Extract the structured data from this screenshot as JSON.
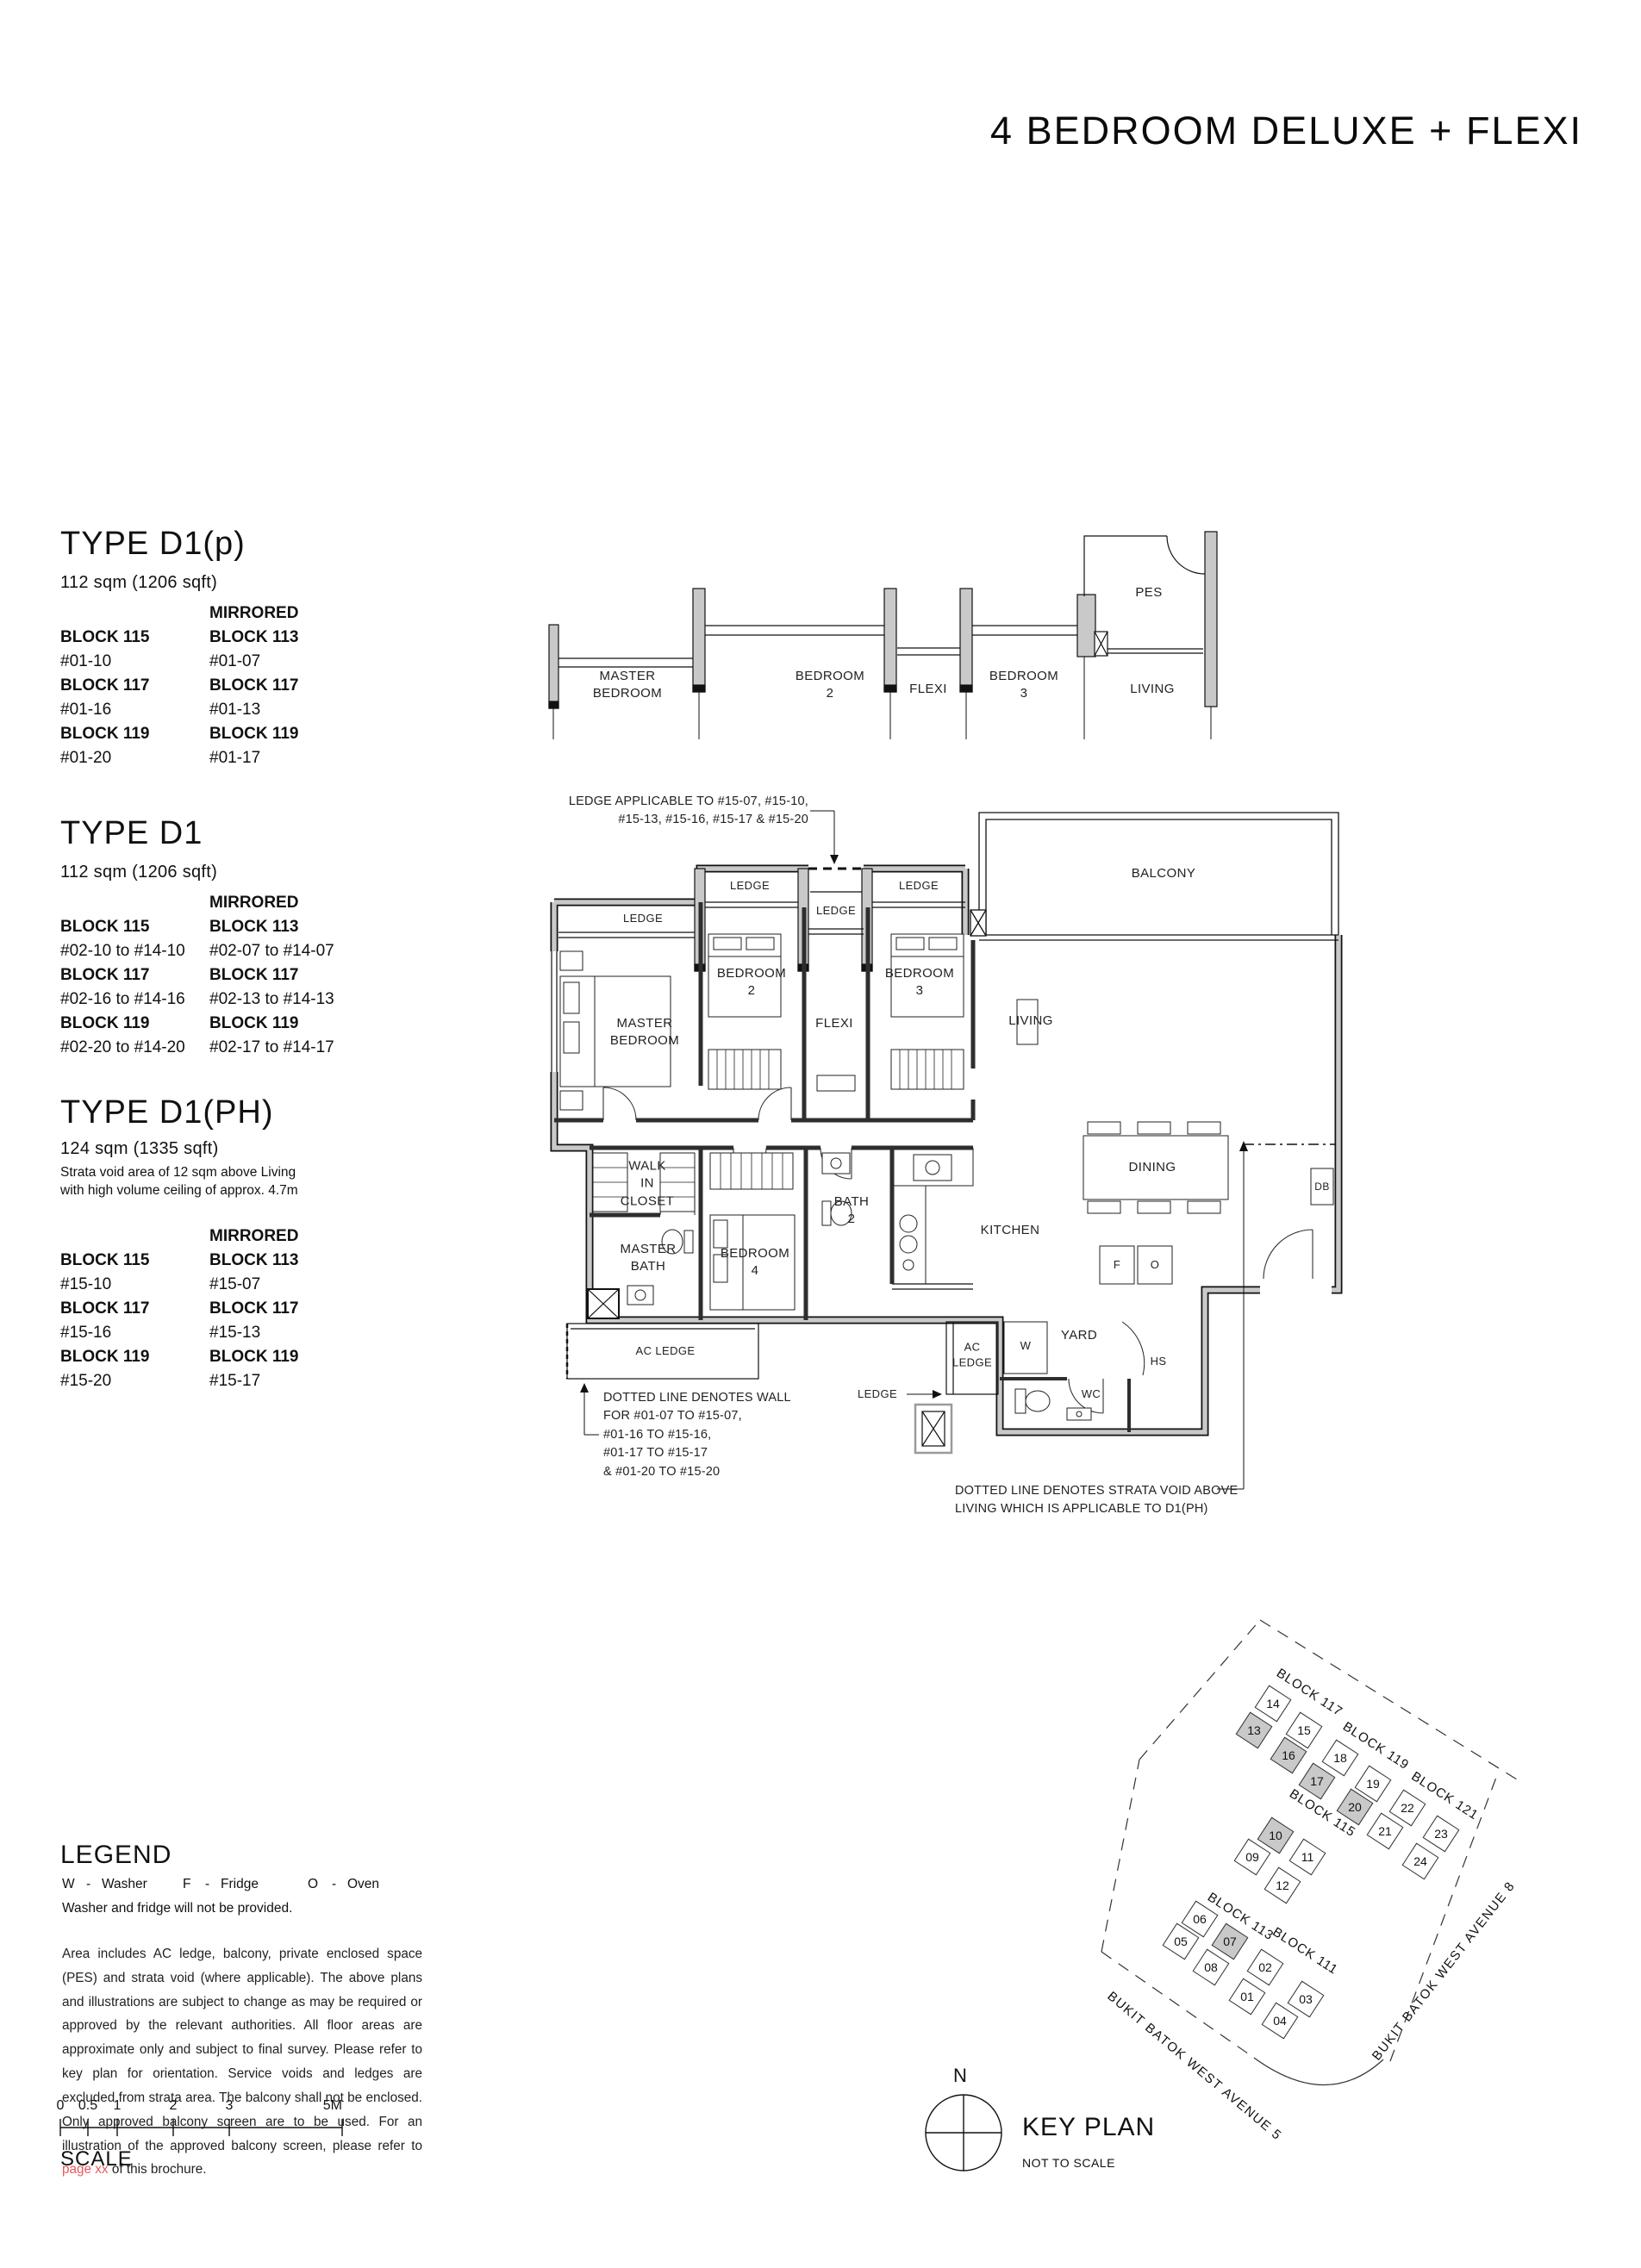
{
  "title": "4 BEDROOM DELUXE + FLEXI",
  "types": [
    {
      "name": "TYPE D1(p)",
      "area": "112 sqm (1206 sqft)",
      "note": "",
      "mirrored": "MIRRORED",
      "left": [
        [
          "BLOCK 115",
          "#01-10"
        ],
        [
          "BLOCK 117",
          "#01-16"
        ],
        [
          "BLOCK 119",
          "#01-20"
        ]
      ],
      "right": [
        [
          "BLOCK 113",
          "#01-07"
        ],
        [
          "BLOCK 117",
          "#01-13"
        ],
        [
          "BLOCK 119",
          "#01-17"
        ]
      ]
    },
    {
      "name": "TYPE D1",
      "area": "112 sqm (1206 sqft)",
      "note": "",
      "mirrored": "MIRRORED",
      "left": [
        [
          "BLOCK 115",
          "#02-10 to #14-10"
        ],
        [
          "BLOCK 117",
          "#02-16 to #14-16"
        ],
        [
          "BLOCK 119",
          "#02-20 to #14-20"
        ]
      ],
      "right": [
        [
          "BLOCK 113",
          "#02-07 to #14-07"
        ],
        [
          "BLOCK 117",
          "#02-13 to #14-13"
        ],
        [
          "BLOCK 119",
          "#02-17 to #14-17"
        ]
      ]
    },
    {
      "name": "TYPE D1(PH)",
      "area": "124 sqm (1335 sqft)",
      "note": "Strata void area of 12 sqm above Living\nwith high volume ceiling of approx. 4.7m",
      "mirrored": "MIRRORED",
      "left": [
        [
          "BLOCK 115",
          "#15-10"
        ],
        [
          "BLOCK 117",
          "#15-16"
        ],
        [
          "BLOCK 119",
          "#15-20"
        ]
      ],
      "right": [
        [
          "BLOCK 113",
          "#15-07"
        ],
        [
          "BLOCK 117",
          "#15-13"
        ],
        [
          "BLOCK 119",
          "#15-17"
        ]
      ]
    }
  ],
  "plan": {
    "upper": {
      "master": "MASTER\nBEDROOM",
      "bed2": "BEDROOM\n2",
      "flexi": "FLEXI",
      "bed3": "BEDROOM\n3",
      "living": "LIVING",
      "pes": "PES"
    },
    "main": {
      "ledge_left": "LEDGE",
      "ledge_b2": "LEDGE",
      "ledge_mid": "LEDGE",
      "ledge_b3": "LEDGE",
      "balcony": "BALCONY",
      "master": "MASTER\nBEDROOM",
      "bed2": "BEDROOM\n2",
      "flexi": "FLEXI",
      "bed3": "BEDROOM\n3",
      "living": "LIVING",
      "walkin": "WALK\nIN\nCLOSET",
      "masterbath": "MASTER\nBATH",
      "bed4": "BEDROOM\n4",
      "bath2": "BATH\n2",
      "kitchen": "KITCHEN",
      "dining": "DINING",
      "db": "DB",
      "f": "F",
      "o": "O",
      "w": "W",
      "yard": "YARD",
      "hs": "HS",
      "wc": "WC",
      "acledge_left": "AC LEDGE",
      "acledge_mid": "AC\nLEDGE",
      "ledge_sm": "LEDGE"
    },
    "annotations": {
      "ledge_applicable": "LEDGE APPLICABLE TO #15-07, #15-10,\n#15-13, #15-16, #15-17 & #15-20",
      "dotted_wall": "DOTTED LINE DENOTES WALL\nFOR  #01-07 TO #15-07,\n#01-16 TO #15-16,\n#01-17 TO #15-17\n& #01-20 TO #15-20",
      "strata": "DOTTED LINE DENOTES STRATA VOID ABOVE\nLIVING WHICH IS APPLICABLE TO D1(PH)"
    }
  },
  "legend": {
    "heading": "LEGEND",
    "sep": "-",
    "items": [
      [
        "W",
        "Washer"
      ],
      [
        "F",
        "Fridge"
      ],
      [
        "O",
        "Oven"
      ]
    ],
    "note": "Washer and fridge will not be provided."
  },
  "disclaimer": {
    "pre": "Area includes AC ledge, balcony, private enclosed space (PES) and strata void (where applicable). The above plans and illustrations are subject to change as may be required or approved by the relevant authorities. All floor areas are approximate only and subject to final survey. Please refer to key plan for orientation. Service voids and ledges are excluded from strata area. The balcony shall not be enclosed. Only approved balcony screen are to be used. For an illustration of the approved balcony screen, please refer to ",
    "link": "page xx",
    "post": " of this brochure."
  },
  "keyplan": {
    "label": "KEY PLAN",
    "sub": "NOT TO SCALE",
    "north": "N",
    "blocks": [
      "BLOCK 117",
      "BLOCK 119",
      "BLOCK 121",
      "BLOCK 115",
      "BLOCK 113",
      "BLOCK 111"
    ],
    "roads": [
      "BUKIT BATOK WEST AVENUE 5",
      "BUKIT BATOK WEST AVENUE 8"
    ],
    "units": [
      {
        "n": "14"
      },
      {
        "n": "13",
        "hl": true
      },
      {
        "n": "15"
      },
      {
        "n": "16",
        "hl": true
      },
      {
        "n": "18"
      },
      {
        "n": "17",
        "hl": true
      },
      {
        "n": "19"
      },
      {
        "n": "20",
        "hl": true
      },
      {
        "n": "22"
      },
      {
        "n": "21"
      },
      {
        "n": "23"
      },
      {
        "n": "24"
      },
      {
        "n": "10",
        "hl": true
      },
      {
        "n": "09"
      },
      {
        "n": "11"
      },
      {
        "n": "12"
      },
      {
        "n": "06"
      },
      {
        "n": "05"
      },
      {
        "n": "07",
        "hl": true
      },
      {
        "n": "08"
      },
      {
        "n": "02"
      },
      {
        "n": "01"
      },
      {
        "n": "03"
      },
      {
        "n": "04"
      }
    ]
  },
  "scalebar": {
    "ticks": [
      "0",
      "0.5",
      "1",
      "2",
      "3",
      "5M"
    ],
    "label": "SCALE"
  },
  "colors": {
    "wall_gray": "#c9c9c9",
    "accent_red": "#e8595c",
    "ink": "#111111"
  }
}
